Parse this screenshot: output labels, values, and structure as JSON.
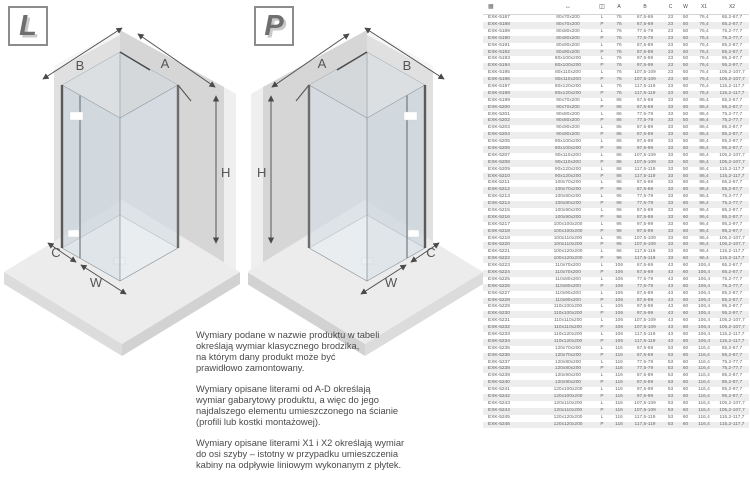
{
  "diagrams": {
    "left": {
      "badge": "L",
      "labels": {
        "a": "A",
        "b": "B",
        "c": "C",
        "h": "H",
        "w": "W"
      }
    },
    "right": {
      "badge": "P",
      "labels": {
        "a": "A",
        "b": "B",
        "c": "C",
        "h": "H",
        "w": "W"
      }
    }
  },
  "notes": {
    "p1": "Wymiary podane w nazwie produktu w tabeli\nokreślają wymiar klasycznego brodzika,\nna którym dany produkt może być\nprawidłowo zamontowany.",
    "p2": "Wymiary opisane literami od A-D określają\nwymiar gabarytowy produktu, a więc do jego\nnajdalszego elementu umieszczonego na ścianie\n(profili lub kostki montażowej).",
    "p3": "Wymiary opisane literami X1 i X2 określają wymiar\ndo osi szyby – istotny w przypadku umieszczenia\nkabiny na odpływie liniowym wykonanym z płytek."
  },
  "table": {
    "header": {
      "code_icon": "▦",
      "size_icon": "↔",
      "side_icon": "◫",
      "labels": [
        "A",
        "B",
        "C",
        "W",
        "X1",
        "X2"
      ]
    },
    "rows": [
      [
        "EXK-5187",
        "80x70x200",
        "L",
        "76",
        "67,5-69",
        "23",
        "50",
        "76,4",
        "65,2-67,7"
      ],
      [
        "EXK-5188",
        "80x70x200",
        "P",
        "76",
        "67,5-69",
        "23",
        "50",
        "76,4",
        "65,2-67,7"
      ],
      [
        "EXK-5189",
        "80x80x200",
        "L",
        "76",
        "77,5-79",
        "23",
        "50",
        "76,4",
        "75,2-77,7"
      ],
      [
        "EXK-5190",
        "80x80x200",
        "P",
        "76",
        "77,5-79",
        "23",
        "50",
        "76,4",
        "75,2-77,7"
      ],
      [
        "EXK-5191",
        "80x90x200",
        "L",
        "76",
        "87,5-89",
        "23",
        "50",
        "76,4",
        "85,2-87,7"
      ],
      [
        "EXK-5192",
        "80x90x200",
        "P",
        "76",
        "87,5-89",
        "23",
        "50",
        "76,4",
        "85,2-87,7"
      ],
      [
        "EXK-5193",
        "80x100x200",
        "L",
        "76",
        "97,5-99",
        "23",
        "50",
        "76,4",
        "95,2-97,7"
      ],
      [
        "EXK-5194",
        "80x100x200",
        "P",
        "76",
        "97,5-99",
        "23",
        "50",
        "76,4",
        "95,2-97,7"
      ],
      [
        "EXK-5195",
        "80x110x200",
        "L",
        "76",
        "107,5-109",
        "23",
        "50",
        "76,4",
        "105,2-107,7"
      ],
      [
        "EXK-5196",
        "80x110x200",
        "P",
        "76",
        "107,5-109",
        "23",
        "50",
        "76,4",
        "105,2-107,7"
      ],
      [
        "EXK-5197",
        "80x120x200",
        "L",
        "76",
        "117,5-119",
        "23",
        "50",
        "76,4",
        "115,2-117,7"
      ],
      [
        "EXK-5198",
        "80x120x200",
        "P",
        "76",
        "117,5-119",
        "23",
        "50",
        "76,4",
        "115,2-117,7"
      ],
      [
        "EXK-5199",
        "90x70x200",
        "L",
        "86",
        "67,5-69",
        "33",
        "50",
        "86,4",
        "65,2-67,7"
      ],
      [
        "EXK-5200",
        "90x70x200",
        "P",
        "86",
        "67,5-69",
        "33",
        "50",
        "86,4",
        "65,2-67,7"
      ],
      [
        "EXK-5201",
        "90x80x200",
        "L",
        "86",
        "77,5-79",
        "33",
        "50",
        "86,4",
        "75,2-77,7"
      ],
      [
        "EXK-5202",
        "90x80x200",
        "P",
        "86",
        "77,5-79",
        "33",
        "50",
        "86,4",
        "75,2-77,7"
      ],
      [
        "EXK-5203",
        "90x90x200",
        "L",
        "86",
        "87,5-89",
        "33",
        "50",
        "86,4",
        "85,2-87,7"
      ],
      [
        "EXK-5204",
        "90x90x200",
        "P",
        "86",
        "87,5-89",
        "33",
        "50",
        "86,4",
        "85,2-87,7"
      ],
      [
        "EXK-5205",
        "90x100x200",
        "L",
        "86",
        "97,5-99",
        "33",
        "50",
        "86,4",
        "95,2-97,7"
      ],
      [
        "EXK-5206",
        "90x100x200",
        "P",
        "86",
        "97,5-99",
        "33",
        "50",
        "86,4",
        "95,2-97,7"
      ],
      [
        "EXK-5207",
        "90x110x200",
        "L",
        "86",
        "107,5-109",
        "33",
        "50",
        "86,4",
        "105,2-107,7"
      ],
      [
        "EXK-5208",
        "90x110x200",
        "P",
        "86",
        "107,5-109",
        "33",
        "50",
        "86,4",
        "105,2-107,7"
      ],
      [
        "EXK-5209",
        "90x120x200",
        "L",
        "86",
        "117,5-119",
        "33",
        "50",
        "86,4",
        "115,2-117,7"
      ],
      [
        "EXK-5210",
        "90x120x200",
        "P",
        "86",
        "117,5-119",
        "33",
        "50",
        "86,4",
        "115,2-117,7"
      ],
      [
        "EXK-5211",
        "100x70x200",
        "L",
        "96",
        "67,5-69",
        "33",
        "60",
        "96,4",
        "65,2-67,7"
      ],
      [
        "EXK-5212",
        "100x70x200",
        "P",
        "96",
        "67,5-69",
        "33",
        "60",
        "96,4",
        "65,2-67,7"
      ],
      [
        "EXK-5213",
        "100x80x200",
        "L",
        "96",
        "77,5-79",
        "33",
        "60",
        "96,4",
        "75,2-77,7"
      ],
      [
        "EXK-5214",
        "100x80x200",
        "P",
        "96",
        "77,5-79",
        "33",
        "60",
        "96,4",
        "75,2-77,7"
      ],
      [
        "EXK-5215",
        "100x90x200",
        "L",
        "96",
        "87,5-89",
        "33",
        "60",
        "96,4",
        "85,2-87,7"
      ],
      [
        "EXK-5216",
        "100x90x200",
        "P",
        "96",
        "87,5-89",
        "33",
        "60",
        "96,4",
        "85,2-87,7"
      ],
      [
        "EXK-5217",
        "100x100x200",
        "L",
        "96",
        "97,5-99",
        "33",
        "60",
        "96,4",
        "95,2-97,7"
      ],
      [
        "EXK-5218",
        "100x100x200",
        "P",
        "96",
        "97,5-99",
        "33",
        "60",
        "96,4",
        "95,2-97,7"
      ],
      [
        "EXK-5219",
        "100x110x200",
        "L",
        "96",
        "107,5-109",
        "33",
        "60",
        "96,4",
        "105,2-107,7"
      ],
      [
        "EXK-5220",
        "100x110x200",
        "P",
        "96",
        "107,5-109",
        "33",
        "60",
        "96,4",
        "105,2-107,7"
      ],
      [
        "EXK-5221",
        "100x120x200",
        "L",
        "96",
        "117,5-119",
        "33",
        "60",
        "96,4",
        "115,2-117,7"
      ],
      [
        "EXK-5222",
        "100x120x200",
        "P",
        "96",
        "117,5-119",
        "33",
        "60",
        "96,4",
        "115,2-117,7"
      ],
      [
        "EXK-5223",
        "110x70x200",
        "L",
        "106",
        "67,5-69",
        "43",
        "60",
        "106,4",
        "65,2-67,7"
      ],
      [
        "EXK-5224",
        "110x70x200",
        "P",
        "106",
        "67,5-69",
        "43",
        "60",
        "106,4",
        "65,2-67,7"
      ],
      [
        "EXK-5225",
        "110x80x200",
        "L",
        "106",
        "77,5-79",
        "43",
        "60",
        "106,4",
        "75,2-77,7"
      ],
      [
        "EXK-5226",
        "110x80x200",
        "P",
        "106",
        "77,5-79",
        "43",
        "60",
        "106,4",
        "75,2-77,7"
      ],
      [
        "EXK-5227",
        "110x90x200",
        "L",
        "106",
        "87,5-89",
        "43",
        "60",
        "106,4",
        "85,2-87,7"
      ],
      [
        "EXK-5228",
        "110x90x200",
        "P",
        "106",
        "87,5-89",
        "43",
        "60",
        "106,4",
        "85,2-87,7"
      ],
      [
        "EXK-5229",
        "110x100x200",
        "L",
        "106",
        "97,5-99",
        "43",
        "60",
        "106,4",
        "95,2-97,7"
      ],
      [
        "EXK-5230",
        "110x100x200",
        "P",
        "106",
        "97,5-99",
        "43",
        "60",
        "106,4",
        "95,2-97,7"
      ],
      [
        "EXK-5231",
        "110x110x200",
        "L",
        "106",
        "107,5-109",
        "43",
        "60",
        "106,4",
        "105,2-107,7"
      ],
      [
        "EXK-5232",
        "110x110x200",
        "P",
        "106",
        "107,5-109",
        "43",
        "60",
        "106,4",
        "105,2-107,7"
      ],
      [
        "EXK-5233",
        "110x120x200",
        "L",
        "106",
        "117,5-119",
        "43",
        "60",
        "106,4",
        "115,2-117,7"
      ],
      [
        "EXK-5234",
        "110x120x200",
        "P",
        "106",
        "117,5-119",
        "43",
        "60",
        "106,4",
        "115,2-117,7"
      ],
      [
        "EXK-5235",
        "120x70x200",
        "L",
        "116",
        "67,5-69",
        "53",
        "60",
        "116,4",
        "65,2-67,7"
      ],
      [
        "EXK-5236",
        "120x70x200",
        "P",
        "116",
        "67,5-69",
        "53",
        "60",
        "116,4",
        "65,2-67,7"
      ],
      [
        "EXK-5237",
        "120x80x200",
        "L",
        "116",
        "77,5-79",
        "53",
        "60",
        "116,4",
        "75,2-77,7"
      ],
      [
        "EXK-5238",
        "120x80x200",
        "P",
        "116",
        "77,5-79",
        "53",
        "60",
        "116,4",
        "75,2-77,7"
      ],
      [
        "EXK-5239",
        "120x90x200",
        "L",
        "116",
        "87,5-89",
        "53",
        "60",
        "116,4",
        "85,2-87,7"
      ],
      [
        "EXK-5240",
        "120x90x200",
        "P",
        "116",
        "87,5-89",
        "53",
        "60",
        "116,4",
        "85,2-87,7"
      ],
      [
        "EXK-5241",
        "120x100x200",
        "L",
        "116",
        "97,5-99",
        "53",
        "60",
        "116,4",
        "95,2-97,7"
      ],
      [
        "EXK-5242",
        "120x100x200",
        "P",
        "116",
        "97,5-99",
        "53",
        "60",
        "116,4",
        "95,2-97,7"
      ],
      [
        "EXK-5243",
        "120x110x200",
        "L",
        "116",
        "107,5-109",
        "53",
        "60",
        "116,4",
        "105,2-107,7"
      ],
      [
        "EXK-5244",
        "120x110x200",
        "P",
        "116",
        "107,5-109",
        "53",
        "60",
        "116,4",
        "105,2-107,7"
      ],
      [
        "EXK-5245",
        "120x120x200",
        "L",
        "116",
        "117,5-119",
        "53",
        "60",
        "116,4",
        "115,2-117,7"
      ],
      [
        "EXK-5246",
        "120x120x200",
        "P",
        "116",
        "117,5-119",
        "53",
        "60",
        "116,4",
        "115,2-117,7"
      ]
    ]
  }
}
